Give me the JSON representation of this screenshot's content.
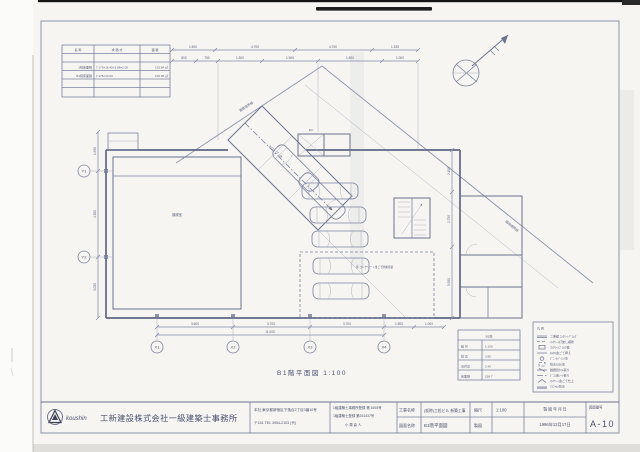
{
  "caption": "B1階平面図 1:100",
  "area_table": {
    "headers": [
      "名 称",
      "求 積 式",
      "面 積"
    ],
    "rows": [
      {
        "name": "1階床面積",
        "formula": "7.175×16.40+3.88×2.05",
        "area": "125.64 ㎡"
      },
      {
        "name": "B1階床面積",
        "formula": "7.175×14.00",
        "area": "100.45 ㎡"
      }
    ]
  },
  "dims": {
    "top1": [
      "1.500",
      "4.700",
      "4.750",
      "1.335"
    ],
    "top2": [
      "800",
      "750",
      "1.500",
      "1.905",
      "1.500",
      "1.000"
    ],
    "bottom1": [
      "3.600",
      "3.700",
      "3.700"
    ],
    "bottom_right": [
      "1.500",
      "1.000"
    ],
    "bottom_total": "11.000",
    "left": [
      "1.950",
      "4.300",
      "3.050"
    ],
    "right": [
      "2.100",
      "2.750",
      "3.550"
    ]
  },
  "grid": {
    "x": [
      "X1",
      "X2",
      "X3",
      "X4"
    ],
    "y": [
      "Y1",
      "Y2"
    ]
  },
  "plan": {
    "labels": {
      "machine_room": "機械室",
      "ramp": "スロープ 1/8",
      "ev": "EV",
      "floor_note": "床:コンクリート金ごて防塵塗装",
      "boundary_road": "道路境界線",
      "boundary_site": "隣地境界線"
    }
  },
  "data_table": {
    "title": "B1階",
    "rows": [
      {
        "label": "縮 尺",
        "value": "1:100"
      },
      {
        "label": "階 高",
        "value": "3.85"
      },
      {
        "label": "天井高",
        "value": "2.40"
      },
      {
        "label": "床面積",
        "value": "158.7"
      }
    ]
  },
  "legend": {
    "title": "凡 例",
    "items": [
      {
        "label": "二重壁 ｺﾝｸﾘｰﾄﾌﾞﾛｯｸ"
      },
      {
        "label": "ｺﾝｸﾘｰﾄ打放し補修"
      },
      {
        "label": "ｺﾝｸﾘｰﾄﾌﾞﾛｯｸ積"
      },
      {
        "label": "ﾓﾙﾀﾙ金ごて押え"
      },
      {
        "label": "ﾋﾞﾆｰﾙﾍﾟｲﾝﾄ塗"
      },
      {
        "label": "防水ﾓﾙﾀﾙ塗"
      },
      {
        "label": "磁器質ﾀｲﾙ張り"
      },
      {
        "label": "ﾋﾞﾆﾙ床ｼｰﾄ張り"
      },
      {
        "label": "ｺﾝｸﾘｰﾄ金ごて仕上"
      },
      {
        "label": "ｱｽﾌｧﾙﾄ防水"
      }
    ]
  },
  "title_block": {
    "logo_text": "koushin",
    "company": "工新建設株式会社一級建築士事務所",
    "address_line1": "本社 東京都新宿区下落合2丁目3番10号",
    "address_line2": "〒161  TEL 3954-2103 (代)",
    "reg_line1": "1級建築士事務所登録 第 1693号",
    "reg_line2": "1級建築士登録 第261437号",
    "reg_line3": "小 栗 喜 人",
    "project_label": "工事名称",
    "project_value": "(仮称)工松ビル 新築工事",
    "drawing_label": "図面名称",
    "drawing_value": "B1階平面図",
    "scale_label": "縮尺",
    "scale_value": "1:100",
    "draft_label": "製図",
    "date_label": "製 図 年 月 日",
    "date_value": "1996年12月17日",
    "number_label": "図面番号",
    "number_value": "A-10"
  }
}
